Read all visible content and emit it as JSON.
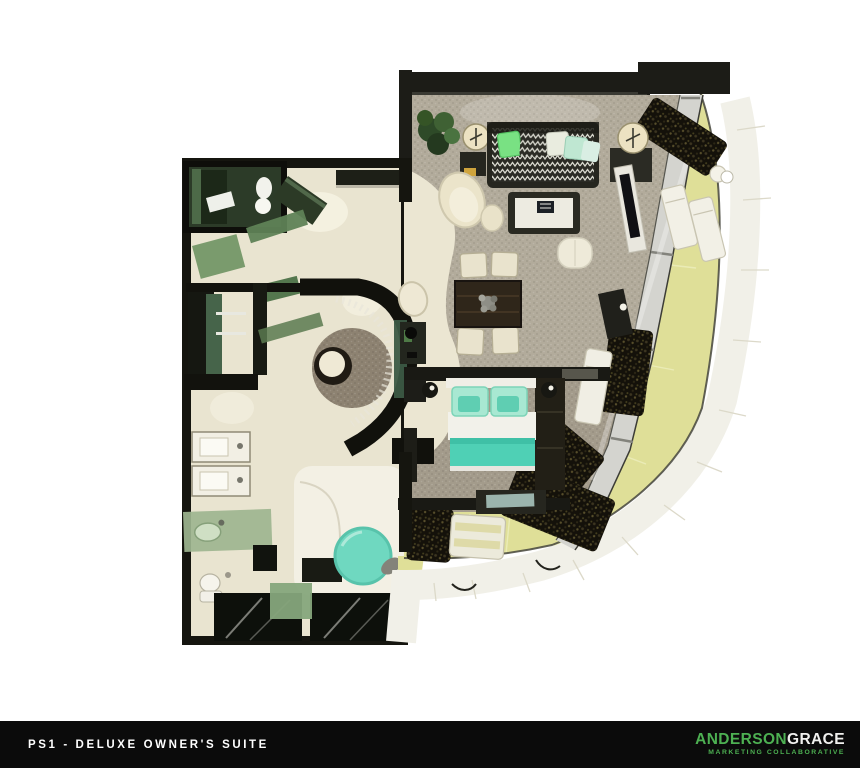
{
  "footer": {
    "plan_code_label": "PS1 - DELUXE OWNER'S SUITE",
    "brand": {
      "name_primary": "ANDERSON",
      "name_secondary": "GRACE",
      "tagline": "MARKETING COLLABORATIVE"
    }
  },
  "palette": {
    "page_background": "#ffffff",
    "footer_background": "#0b0b0b",
    "footer_text": "#ffffff",
    "logo_green": "#4db052",
    "logo_white": "#f0f0ee",
    "wall_black": "#1c1c17",
    "floor_beige": "#eae5d1",
    "carpet_gray": "#b2ab9b",
    "carpet_bedroom": "#a39b8b",
    "accent_mint": "#5fd4ba",
    "pillow_green": "#79e183",
    "balcony_yellow": "#dfdf98",
    "deck_white": "#f1f0e8",
    "glass_green": "#7d9a70",
    "hedge_dark": "#14110a",
    "window_gray": "#d4d4cf",
    "gold_accent": "#cfa43d"
  }
}
